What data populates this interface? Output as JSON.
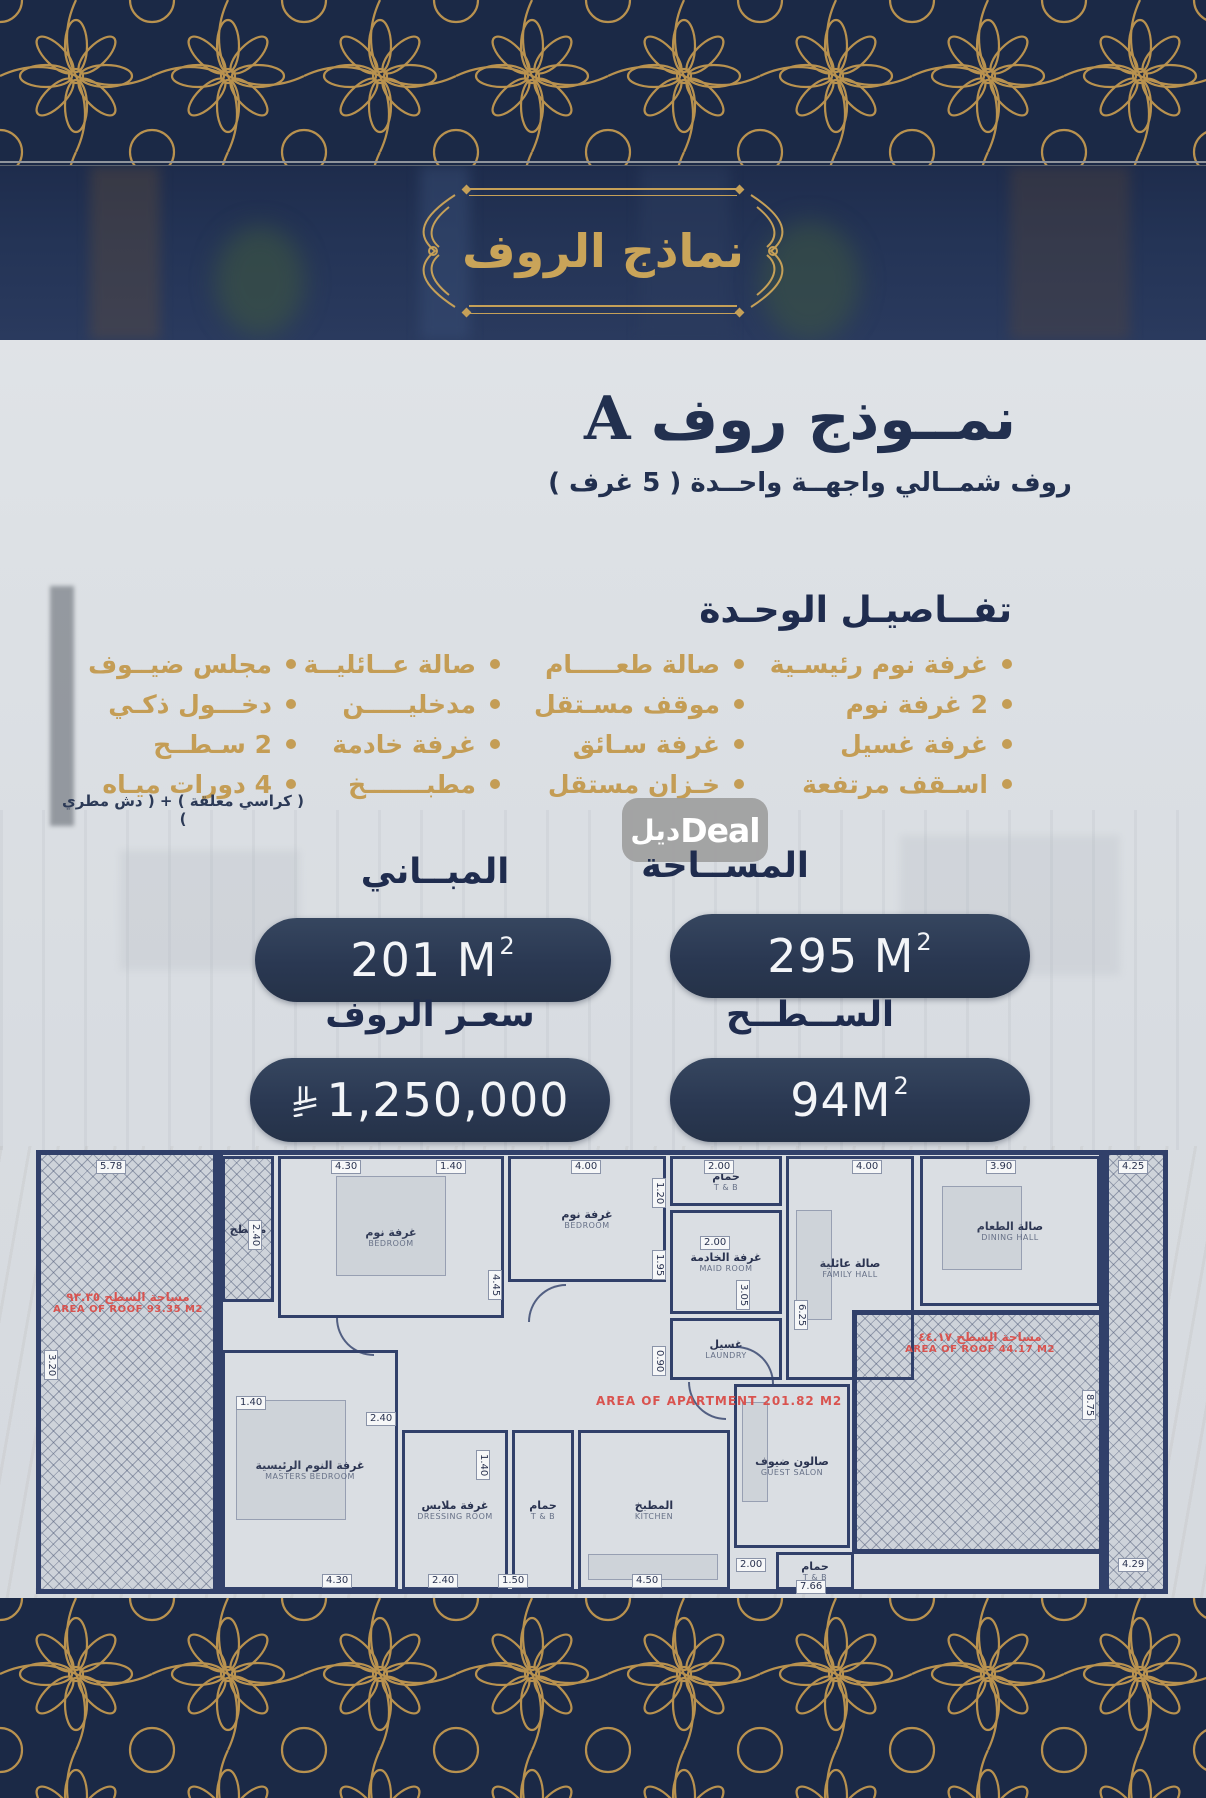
{
  "colors": {
    "navy": "#22304f",
    "gold": "#c49d55",
    "pill_bg": "#2b3a55",
    "band_bg": "#1b2946",
    "red": "#d9534f"
  },
  "banner": {
    "title": "نماذج الروف"
  },
  "model": {
    "title_ar": "نمــوذج روف",
    "title_letter": "A",
    "subtitle": "روف شمــالي واجهــة واحــدة  ( 5 غرف )",
    "details_heading": "تفــاصيـل الوحـدة"
  },
  "features": {
    "col1": [
      {
        "t": "غرفة نوم رئيسـية"
      },
      {
        "t": "صالة طعـــــام"
      },
      {
        "t": "صالة عــائليــة"
      },
      {
        "t": "مجلس ضيــوف"
      }
    ],
    "col2": [
      {
        "t": "2 غرفة نوم"
      },
      {
        "t": "موقف مسـتقل"
      },
      {
        "t": "مدخليـــــن"
      },
      {
        "t": "دخـــول ذكـي"
      }
    ],
    "col3": [
      {
        "t": "غرفة غسيل"
      },
      {
        "t": "غرفة سـائق"
      },
      {
        "t": "غرفة خادمة"
      },
      {
        "t": "2 سـطــح"
      }
    ],
    "col4": [
      {
        "t": "اسـقف مرتفعة"
      },
      {
        "t": "خـزان مستقل"
      },
      {
        "t": "مطبـــــــخ"
      },
      {
        "t": "4 دورات ميـاه"
      }
    ],
    "footnote": "( كراسي معلقة ) + ( دش مطري )"
  },
  "watermark": {
    "ar": "ديل",
    "en": "Deal"
  },
  "stats": {
    "area": {
      "label": "المســاحة",
      "value": "295 M",
      "sup": "2"
    },
    "buildings": {
      "label": "المبــاني",
      "value": "201 M",
      "sup": "2"
    },
    "surface": {
      "label": "الســطــح",
      "value": "94M",
      "sup": "2"
    },
    "price": {
      "label": "سعـر الروف",
      "value": "1,250,000"
    }
  },
  "plan": {
    "apartment_area_label": "AREA OF APARTMENT 201.82 M2",
    "left_roof_ar": "مساحة السطح ٩٣.٣٥",
    "left_roof_en": "AREA OF ROOF 93.35 M2",
    "right_roof_ar": "مساحة السطح ٤٤.١٧",
    "right_roof_en": "AREA OF ROOF 44.17 M2",
    "rooms": [
      {
        "ar": "مسطح",
        "en": "",
        "x": 186,
        "y": 6,
        "w": 52,
        "h": 146,
        "hatch": true
      },
      {
        "ar": "غرفة نوم",
        "en": "BEDROOM",
        "x": 242,
        "y": 6,
        "w": 226,
        "h": 162
      },
      {
        "ar": "غرفة نوم",
        "en": "BEDROOM",
        "x": 472,
        "y": 6,
        "w": 158,
        "h": 126
      },
      {
        "ar": "حمام",
        "en": "T & B",
        "x": 634,
        "y": 6,
        "w": 112,
        "h": 50
      },
      {
        "ar": "غرفة الخادمة",
        "en": "MAID ROOM",
        "x": 634,
        "y": 60,
        "w": 112,
        "h": 104
      },
      {
        "ar": "غسيل",
        "en": "LAUNDRY",
        "x": 634,
        "y": 168,
        "w": 112,
        "h": 62
      },
      {
        "ar": "صالة عائلية",
        "en": "FAMILY HALL",
        "x": 750,
        "y": 6,
        "w": 128,
        "h": 224
      },
      {
        "ar": "صالة الطعام",
        "en": "DINING HALL",
        "x": 884,
        "y": 6,
        "w": 180,
        "h": 150
      },
      {
        "ar": "غرفة النوم الرئيسية",
        "en": "MASTERS BEDROOM",
        "x": 186,
        "y": 200,
        "w": 176,
        "h": 240
      },
      {
        "ar": "غرفة ملابس",
        "en": "DRESSING ROOM",
        "x": 366,
        "y": 280,
        "w": 106,
        "h": 160
      },
      {
        "ar": "حمام",
        "en": "T & B",
        "x": 476,
        "y": 280,
        "w": 62,
        "h": 160
      },
      {
        "ar": "المطبخ",
        "en": "KITCHEN",
        "x": 542,
        "y": 280,
        "w": 152,
        "h": 160
      },
      {
        "ar": "صالون ضيوف",
        "en": "GUEST SALON",
        "x": 698,
        "y": 234,
        "w": 116,
        "h": 164
      },
      {
        "ar": "حمام",
        "en": "T & B",
        "x": 740,
        "y": 402,
        "w": 78,
        "h": 38
      }
    ],
    "dims": [
      {
        "t": "5.78",
        "x": 60,
        "y": 10
      },
      {
        "t": "4.30",
        "x": 295,
        "y": 10
      },
      {
        "t": "1.40",
        "x": 400,
        "y": 10
      },
      {
        "t": "4.00",
        "x": 535,
        "y": 10
      },
      {
        "t": "2.00",
        "x": 668,
        "y": 10
      },
      {
        "t": "4.00",
        "x": 816,
        "y": 10
      },
      {
        "t": "3.90",
        "x": 950,
        "y": 10
      },
      {
        "t": "4.25",
        "x": 1082,
        "y": 10
      },
      {
        "t": "2.40",
        "x": 212,
        "y": 70,
        "r": true
      },
      {
        "t": "1.20",
        "x": 616,
        "y": 28,
        "r": true
      },
      {
        "t": "1.95",
        "x": 616,
        "y": 100,
        "r": true
      },
      {
        "t": "2.00",
        "x": 664,
        "y": 86
      },
      {
        "t": "3.05",
        "x": 700,
        "y": 130,
        "r": true
      },
      {
        "t": "0.90",
        "x": 616,
        "y": 196,
        "r": true
      },
      {
        "t": "4.45",
        "x": 452,
        "y": 120,
        "r": true
      },
      {
        "t": "6.25",
        "x": 758,
        "y": 150,
        "r": true
      },
      {
        "t": "8.75",
        "x": 1046,
        "y": 240,
        "r": true
      },
      {
        "t": "3.20",
        "x": 8,
        "y": 200,
        "r": true
      },
      {
        "t": "1.40",
        "x": 200,
        "y": 246
      },
      {
        "t": "2.40",
        "x": 330,
        "y": 262
      },
      {
        "t": "1.40",
        "x": 440,
        "y": 300,
        "r": true
      },
      {
        "t": "4.30",
        "x": 286,
        "y": 424
      },
      {
        "t": "2.40",
        "x": 392,
        "y": 424
      },
      {
        "t": "1.50",
        "x": 462,
        "y": 424
      },
      {
        "t": "4.50",
        "x": 596,
        "y": 424
      },
      {
        "t": "2.00",
        "x": 700,
        "y": 408
      },
      {
        "t": "7.66",
        "x": 760,
        "y": 430
      },
      {
        "t": "4.29",
        "x": 1082,
        "y": 408
      }
    ]
  }
}
